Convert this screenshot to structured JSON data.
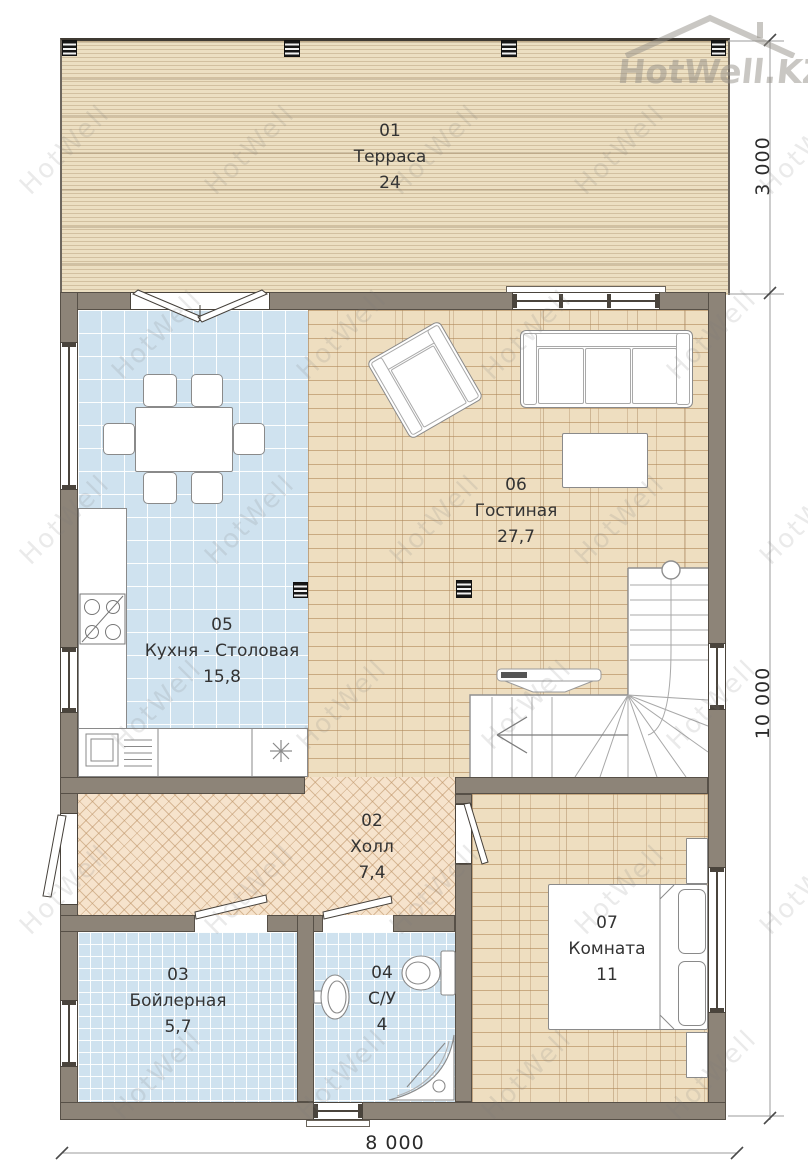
{
  "watermark": {
    "text": "HotWell",
    "logo_text": "HotWell.KZ"
  },
  "rooms": {
    "terrace": {
      "number": "01",
      "name": "Терраса",
      "area": "24"
    },
    "hall": {
      "number": "02",
      "name": "Холл",
      "area": "7,4"
    },
    "boiler": {
      "number": "03",
      "name": "Бойлерная",
      "area": "5,7"
    },
    "bathroom": {
      "number": "04",
      "name": "С/У",
      "area": "4"
    },
    "kitchen": {
      "number": "05",
      "name": "Кухня - Столовая",
      "area": "15,8"
    },
    "living": {
      "number": "06",
      "name": "Гостиная",
      "area": "27,7"
    },
    "bedroom": {
      "number": "07",
      "name": "Комната",
      "area": "11"
    }
  },
  "dimensions": {
    "terrace_depth": "3 000",
    "house_depth": "10 000",
    "house_width": "8 000"
  },
  "colors": {
    "wall": "#8d8478",
    "deck": "#ecdfc2",
    "tile_blue": "#cfe2ef",
    "parquet": "#eedec0",
    "herringbone": "#f6e3cc",
    "line_dark": "#4a443c"
  }
}
